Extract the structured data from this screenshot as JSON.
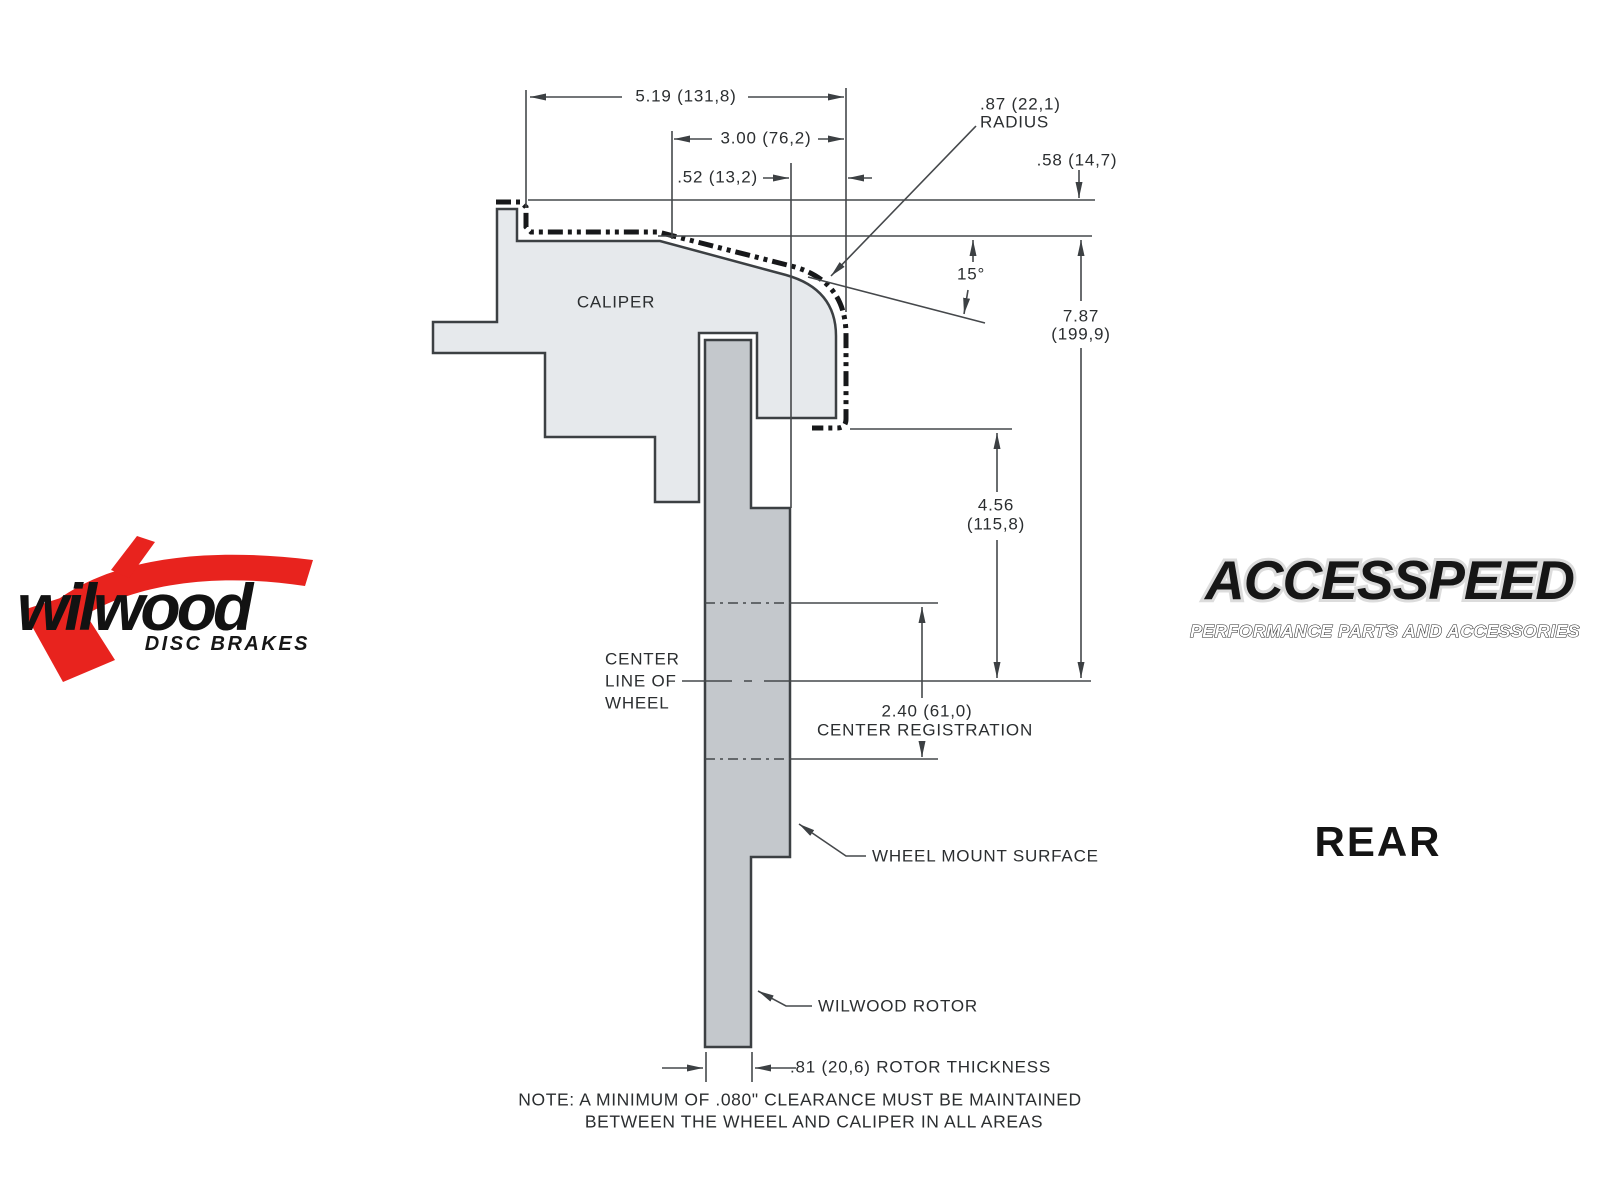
{
  "drawing": {
    "caliper_label": "CALIPER",
    "dims": {
      "d519": "5.19 (131,8)",
      "d300": "3.00 (76,2)",
      "d052": ".52 (13,2)",
      "d087_line1": ".87 (22,1)",
      "d087_line2": "RADIUS",
      "d058": ".58 (14,7)",
      "angle": "15°",
      "d787_line1": "7.87",
      "d787_line2": "(199,9)",
      "d456_line1": "4.56",
      "d456_line2": "(115,8)",
      "d240_line1": "2.40 (61,0)",
      "d240_line2": "CENTER REGISTRATION",
      "rotor_thickness": ".81 (20,6) ROTOR THICKNESS"
    },
    "annotations": {
      "centerline_1": "CENTER",
      "centerline_2": "LINE OF",
      "centerline_3": "WHEEL",
      "wheel_mount": "WHEEL MOUNT SURFACE",
      "rotor": "WILWOOD ROTOR",
      "note_1": "NOTE: A MINIMUM OF .080\" CLEARANCE MUST BE MAINTAINED",
      "note_2": "BETWEEN THE WHEEL AND CALIPER IN ALL AREAS"
    }
  },
  "logos": {
    "wilwood": {
      "name": "wilwood",
      "tagline": "DISC BRAKES"
    },
    "accesspeed": {
      "name": "ACCESSPEED",
      "tagline": "PERFORMANCE PARTS AND ACCESSORIES"
    }
  },
  "view_label": "REAR",
  "colors": {
    "caliper_fill": "#e6e9ec",
    "rotor_fill": "#c4c8cc",
    "outline": "#3c4043",
    "line": "#45484b",
    "text": "#2b2e30",
    "wilwood_red": "#e8231e"
  }
}
